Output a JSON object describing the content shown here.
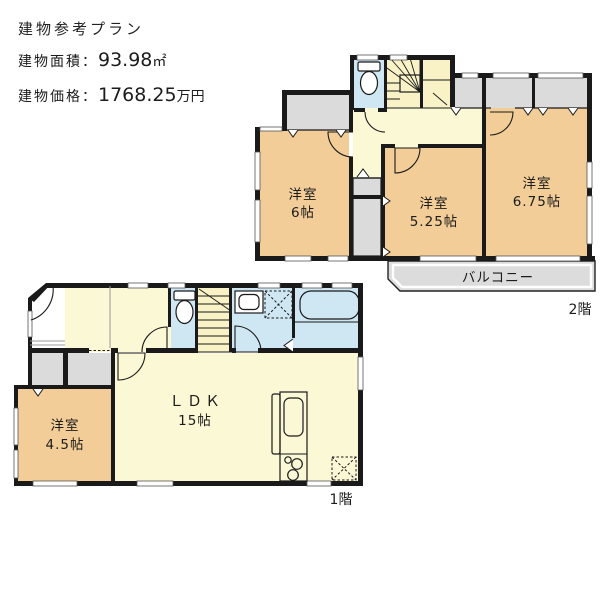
{
  "header": {
    "title": "建物参考プラン",
    "area_label": "建物面積",
    "colon": "：",
    "area_value": "93.98",
    "area_unit": "㎡",
    "price_label": "建物価格",
    "price_value": "1768.25",
    "price_unit": "万円"
  },
  "floor2": {
    "floor_label": "2階",
    "balcony_label": "バルコニー",
    "rooms": [
      {
        "name": "洋室",
        "size": "6帖"
      },
      {
        "name": "洋室",
        "size": "5.25帖"
      },
      {
        "name": "洋室",
        "size": "6.75帖"
      }
    ]
  },
  "floor1": {
    "floor_label": "1階",
    "rooms": [
      {
        "name": "洋室",
        "size": "4.5帖"
      },
      {
        "name": "ＬＤＫ",
        "size": "15帖"
      }
    ]
  },
  "colors": {
    "wall": "#1a1a1a",
    "room_orange": "#F2CD97",
    "floor_yellow": "#FBF8D6",
    "stairs_yellow": "#F8F2C6",
    "water_blue": "#CFE7F3",
    "closet_gray": "#DBDBDB",
    "balcony_gray": "#DCDCDC"
  }
}
